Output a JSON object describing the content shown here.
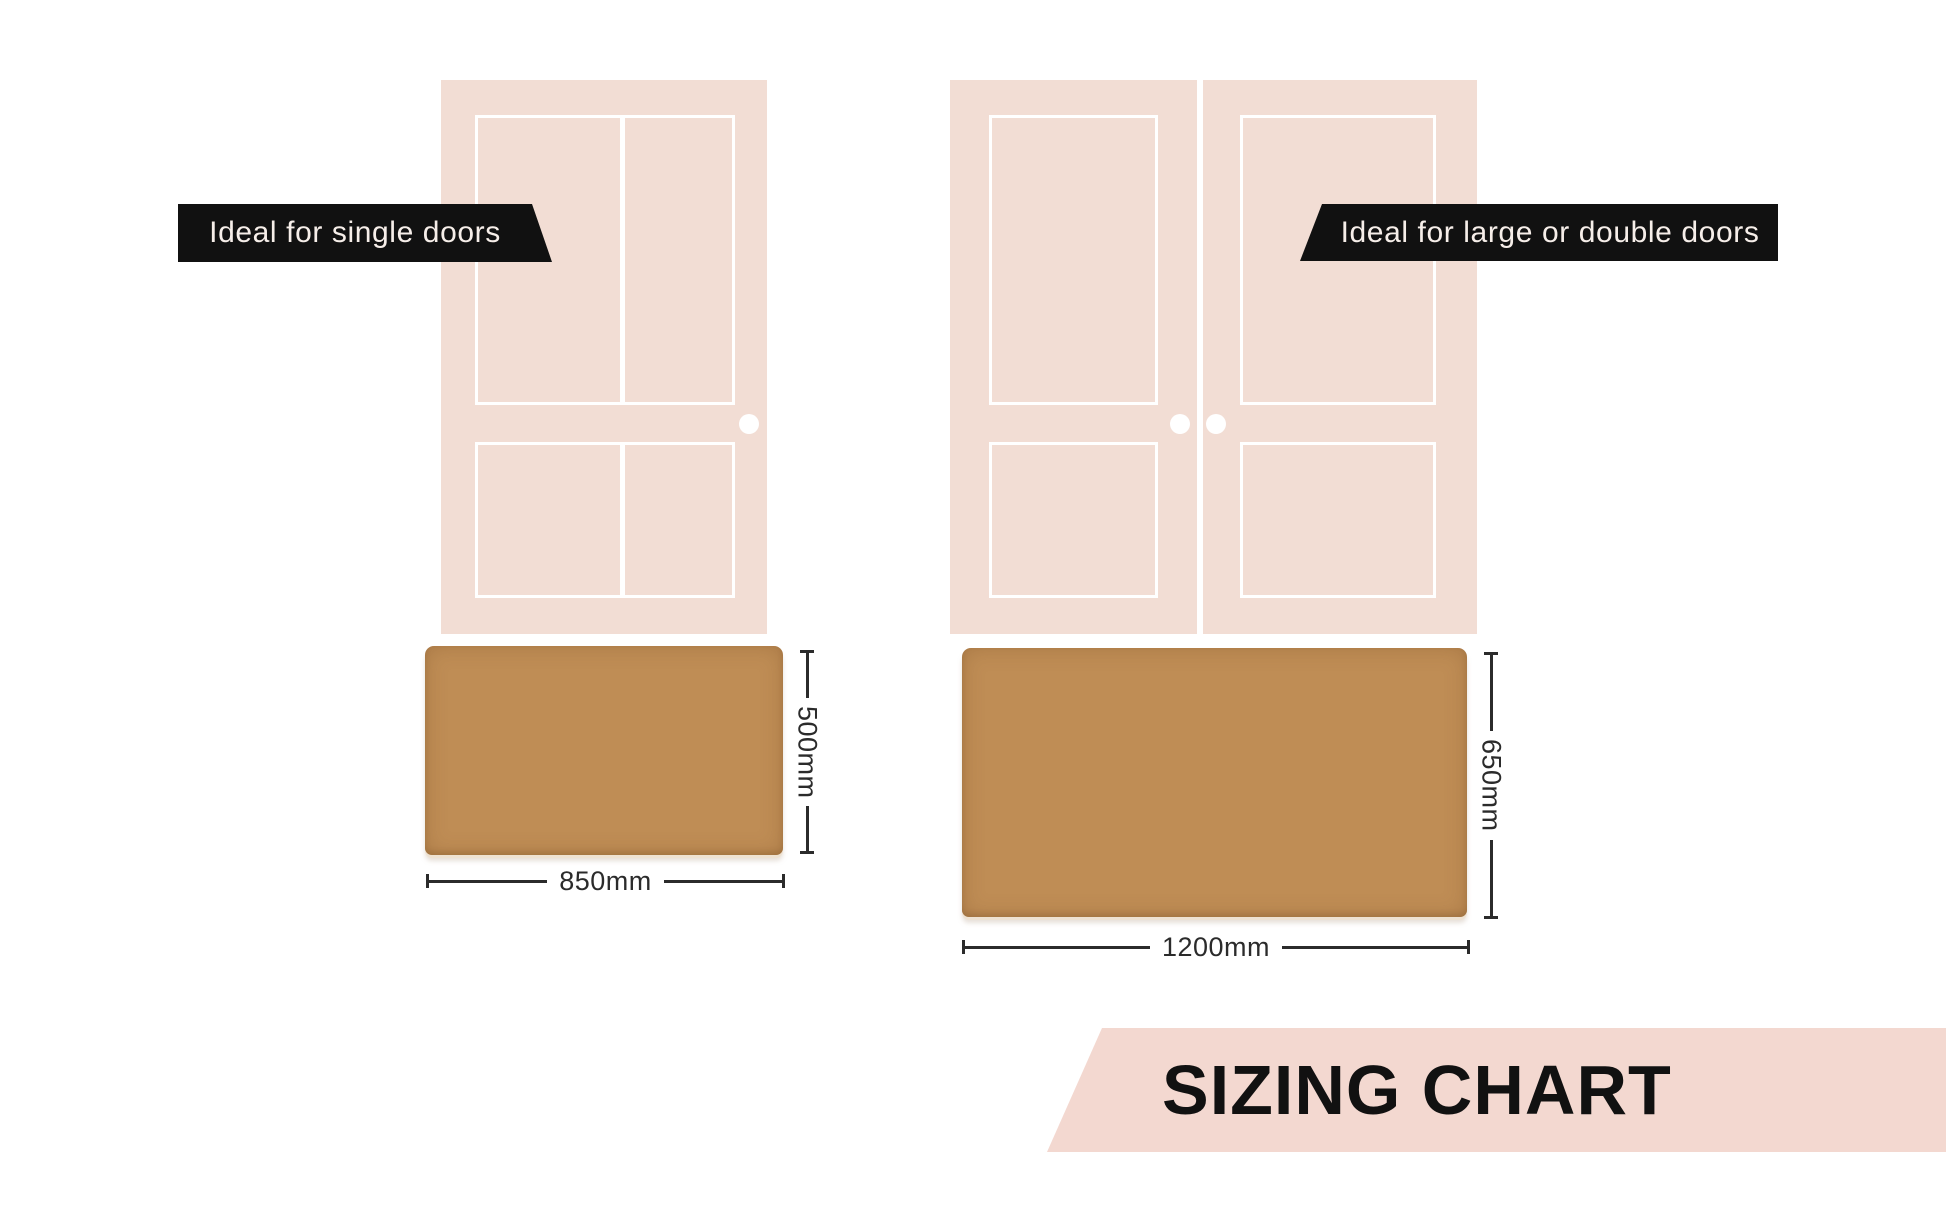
{
  "page": {
    "background": "#ffffff",
    "width_px": 1946,
    "height_px": 1216
  },
  "colors": {
    "door_fill": "#f2ddd4",
    "panel_outline": "#ffffff",
    "banner_bg": "#111111",
    "banner_text": "#f6eee9",
    "mat_coir": "#bf8d55",
    "dimension_line": "#2b2b2b",
    "footer_band_bg": "#f3d8d0",
    "footer_text": "#111111"
  },
  "icons": {
    "door_knob": "white-circle"
  },
  "banners": {
    "single": "Ideal for single doors",
    "double": "Ideal for large or double doors"
  },
  "mats": {
    "single": {
      "width_label": "850mm",
      "height_label": "500mm"
    },
    "double": {
      "width_label": "1200mm",
      "height_label": "650mm"
    }
  },
  "footer": {
    "title": "SIZING CHART"
  }
}
